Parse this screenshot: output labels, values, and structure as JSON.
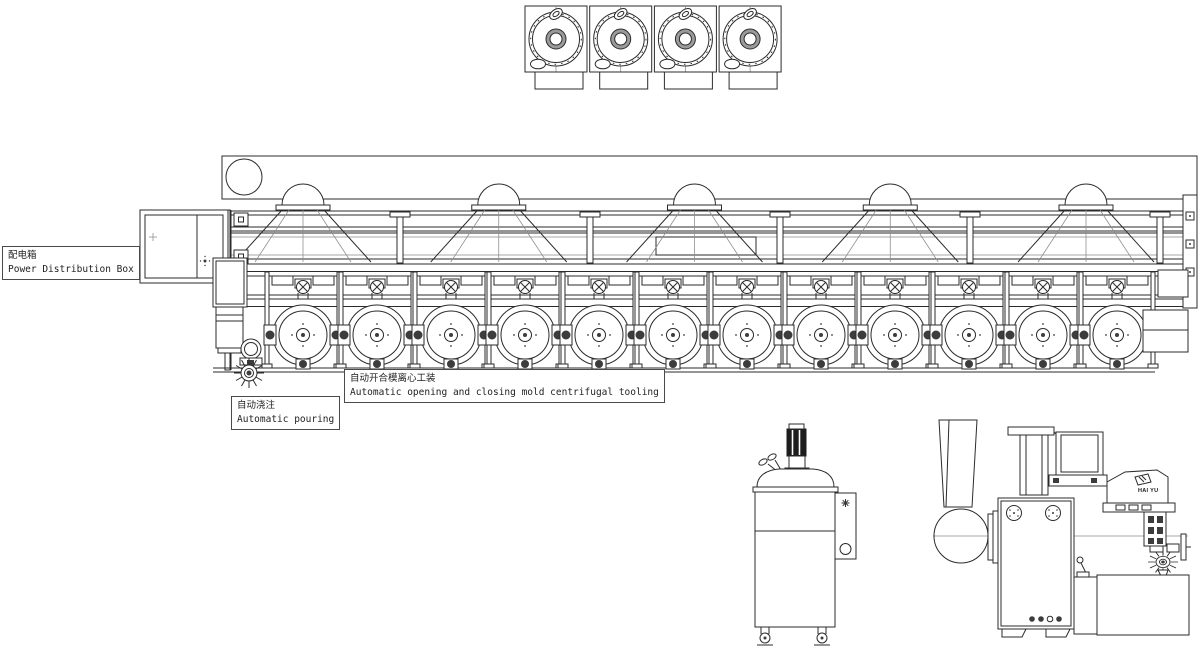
{
  "page": {
    "background": "#ffffff",
    "line_color": "#2b2b2b"
  },
  "labels": {
    "power_box": {
      "zh": "配电箱",
      "en": "Power Distribution Box"
    },
    "tooling": {
      "zh": "自动开合模离心工装",
      "en": "Automatic opening and closing mold centrifugal tooling"
    },
    "pouring": {
      "zh": "自动浇注",
      "en": "Automatic pouring"
    }
  },
  "brand": "HAI YU",
  "machine_line": {
    "mold_station_count": 12,
    "hood_dome_count": 5,
    "top_view_unit_count": 4
  },
  "repeats": [
    {
      "container": "top-view-units",
      "symbol": "sym-top-unit",
      "count": 4,
      "x0": 525,
      "pitch": 64.7
    },
    {
      "container": "hood-domes",
      "symbol": "sym-dome",
      "count": 5,
      "x0": 303,
      "pitch": 195.75
    },
    {
      "container": "t-posts",
      "symbol": "sym-tpost",
      "count": 5,
      "x0": 400,
      "pitch": 190
    },
    {
      "container": "mold-stations",
      "symbol": "sym-station",
      "count": 12,
      "x0": 303,
      "pitch": 74
    }
  ]
}
